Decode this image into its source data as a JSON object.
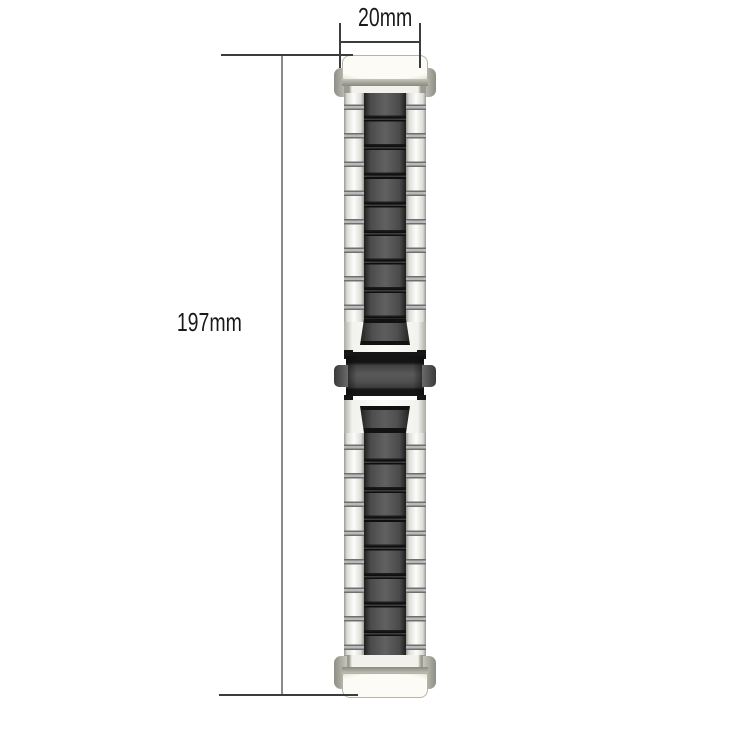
{
  "dimensions": {
    "width_label": "20mm",
    "length_label": "197mm"
  },
  "colors": {
    "background": "#ffffff",
    "dim_text": "#1a1a1a",
    "dim_line": "#3c3c3c",
    "dim_line_light": "#8a8a8a",
    "link_light": "#f5f5f2",
    "link_dark": "#4f4f4f",
    "separator_gray": "#6f6f6f",
    "separator_dark": "#121212",
    "cap_white": "#f4f3ec",
    "cap_gray": "#9a998e",
    "clasp_body": "#525252",
    "clasp_edge": "#161616"
  }
}
